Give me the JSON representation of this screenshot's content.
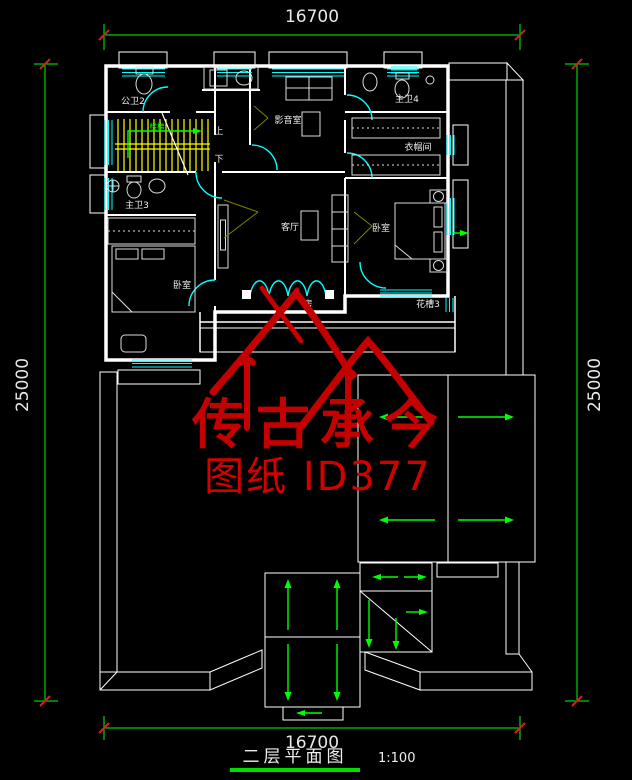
{
  "drawing": {
    "title": "二层平面图",
    "scale": "1:100",
    "type_note": "CAD floor plan, second storey"
  },
  "dimensions": {
    "top": "16700",
    "bottom": "16700",
    "left": "25000",
    "right": "25000"
  },
  "watermark": {
    "line1": "传古承今",
    "line2": "图纸 ID377"
  },
  "labels": {
    "gongwei2": "公卫2",
    "louti": "楼梯",
    "up": "上",
    "down": "下",
    "yingyinshi": "影音室",
    "zhuwei4": "主卫4",
    "yimaojian": "衣帽间",
    "keting": "客厅",
    "woshi_right": "卧室",
    "zhuwei3": "主卫3",
    "woshi_left": "卧室",
    "huacao3": "花槽3",
    "fang": "房"
  },
  "colors": {
    "background": "#000000",
    "wall": "#FFFFFF",
    "glass": "#00FFFF",
    "dimension": "#00FF00",
    "hatch": "#00A000",
    "stair": "#FFFF00",
    "leader": "#808000",
    "watermark": "#C40000",
    "text": "#E8E8E8"
  }
}
